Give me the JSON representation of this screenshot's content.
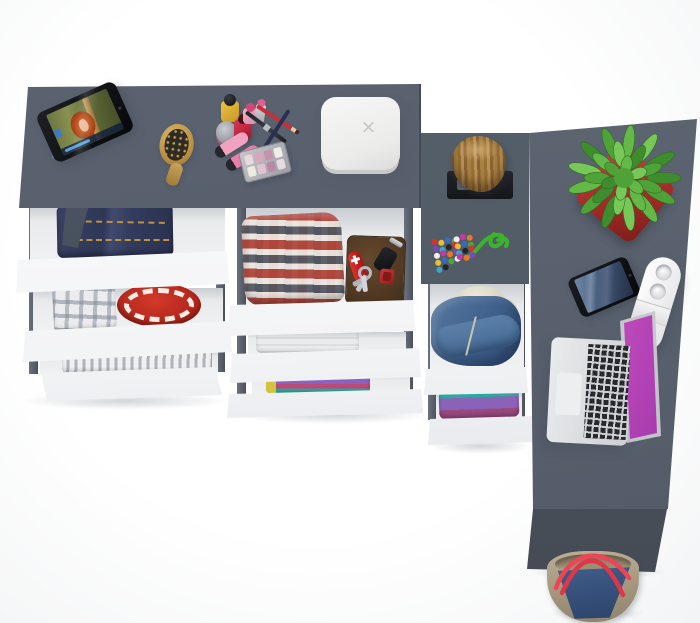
{
  "scene": {
    "description": "Top-down 3D render of an L-shaped anthracite gray desk and dresser combination with eight open white drawers full of folded clothes, and personal accessories arranged on the tops",
    "floor_color": "#ffffff"
  },
  "furniture": {
    "dresser_top_color": "#59616e",
    "column_top_color": "#525c67",
    "desk_top_color": "#5e6673",
    "desk_front_panel_color": "#4c535e",
    "drawer_front_color": "#fcfdfe",
    "drawer_interior_color": "#edeff1",
    "rail_color": "#5e6570",
    "drawer_count": 8
  },
  "white_box": {
    "label": "white rounded storage box",
    "mark": "×",
    "color": "#f0f0ee"
  },
  "objects": {
    "tablet": {
      "label": "tablet on blue stand playing animated movie",
      "frame_color": "#111318",
      "stand_color": "#54aeda",
      "screen_scene": "forest with red-haired character"
    },
    "hairbrush": {
      "label": "wooden oval hairbrush",
      "wood_color": "#b58a3c",
      "bristle_color": "#2e2a24"
    },
    "cosmetics": {
      "label": "makeup set",
      "items": [
        "yellow nail polish",
        "silver cream jar",
        "red nail polish",
        "pink mini bottle",
        "lipstick",
        "two pink lip gloss tubes",
        "black pen",
        "red pencil",
        "navy pencil",
        "eyeshadow palette"
      ],
      "palette_pan_colors": [
        "#eadade",
        "#d9a6bb",
        "#c791ac",
        "#f1eee8",
        "#eeebe3",
        "#e2c2d1",
        "#bb89a5",
        "#e6dae0"
      ]
    },
    "wood_stump": {
      "label": "decorative wood log on black stand",
      "wood_color": "#a87f43",
      "stand_color": "#1c1e23"
    },
    "plant": {
      "label": "green succulent in red pot",
      "pot_color": "#b23331",
      "leaf_colors": [
        "#3e8c2e",
        "#4fa238",
        "#63b848",
        "#77c858"
      ],
      "leaf_count": 28
    },
    "beads": {
      "label": "multicolor bead pouch keychain with green cord",
      "cord_color": "#3cb32c",
      "bead_count": 30,
      "bead_colors": [
        "#d83030",
        "#e8c030",
        "#3868c8",
        "#48a838",
        "#f0f0ee",
        "#c838a0",
        "#e87828",
        "#7848b8",
        "#38a8c8",
        "#262626"
      ]
    },
    "jeans": {
      "label": "folded blue jeans",
      "color": "#343c5e",
      "stitch_color": "#c1913f"
    },
    "plaid_shirt": {
      "label": "folded gray plaid shirt",
      "color": "#ececee"
    },
    "red_dish": {
      "label": "round red folded garment with white pattern",
      "color": "#b42619"
    },
    "striped_clothes": {
      "label": "folded gray striped clothes",
      "color": "#c5c9cf"
    },
    "plaid_shorts": {
      "label": "folded red and gray plaid shorts",
      "colors": [
        "#ac3e34",
        "#464a56",
        "#ece6e0"
      ]
    },
    "wallet": {
      "label": "brown leather wallet with pocket knife, keys and keychain",
      "leather_color": "#4c3520",
      "knife_color": "#cc2222"
    },
    "towel": {
      "label": "folded cream towel",
      "color": "#ddd9c9"
    },
    "stacked_clothes": {
      "label": "stack of colorful folded clothes",
      "colors": [
        "#2fb3ab",
        "#8a63bf",
        "#bf4a79",
        "#d3c23c"
      ]
    },
    "hoodie": {
      "label": "blue hoodie with cream lining",
      "body_color": "#44678f",
      "lining_color": "#e6e2d2"
    },
    "purple_teal_clothes": {
      "label": "folded teal and purple clothes",
      "colors": [
        "#2da89f",
        "#8a63b8",
        "#99497f"
      ]
    },
    "phone": {
      "label": "smartphone with icy blue lock screen",
      "body_color": "#101218",
      "screen_color": "#43597a"
    },
    "power_strip": {
      "label": "white power strip with round sockets",
      "color": "#f4f4f6"
    },
    "laptop": {
      "label": "open silver laptop with magenta wallpaper",
      "body_color": "#d5d8da",
      "key_color": "#28292d",
      "screen_colors": [
        "#f590dd",
        "#a83cb0",
        "#6a2090"
      ]
    },
    "tote_bag": {
      "label": "denim tote bag with red handles",
      "canvas_color": "#a3967d",
      "denim_color": "#35507a",
      "strap_color": "#ee4456"
    }
  }
}
